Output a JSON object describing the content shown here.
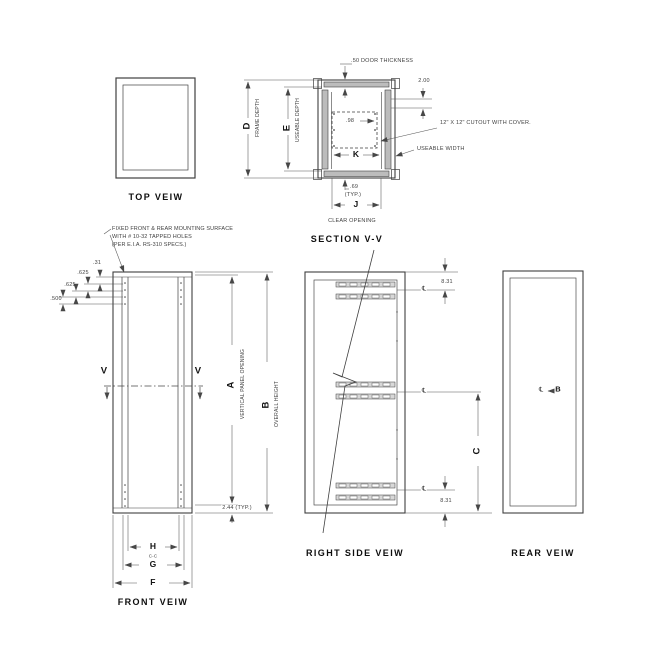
{
  "drawing": {
    "top_view": {
      "title": "TOP VEIW"
    },
    "depth_dims": {
      "d_label": "D",
      "frame_depth": "FRAME DEPTH",
      "e_label": "E",
      "useable_depth": "USEABLE DEPTH"
    },
    "section_view": {
      "title": "SECTION V-V",
      "door_thickness_note": ".50 DOOR THICKNESS",
      "dim_2_00": "2.00",
      "dim_0_98": ".98",
      "cutout_note": "12\" X 12\" CUTOUT WITH COVER.",
      "useable_width_label": "USEABLE WIDTH",
      "k_label": "K",
      "dim_0_69": ".69",
      "typ_note": "(TYP.)",
      "j_label": "J",
      "clear_opening_label": "CLEAR OPENING"
    },
    "front_view": {
      "title": "FRONT VEIW",
      "mounting_note_line1": "FIXED FRONT & REAR MOUNTING SURFACE",
      "mounting_note_line2": "WITH # 10-32 TAPPED HOLES",
      "mounting_note_line3": "(PER E.I.A. RS-310 SPECS.)",
      "hole_dim_1": ".500",
      "hole_dim_2": ".625",
      "hole_dim_3": ".625",
      "hole_dim_4": ".31",
      "section_cut_label_left": "V",
      "section_cut_label_right": "V",
      "a_label": "A",
      "vertical_panel_opening": "VERTICAL PANEL OPENING",
      "b_label": "B",
      "overall_height": "OVERALL HEIGHT",
      "dim_2_44": "2.44 (TYP.)",
      "h_label": "H",
      "center_to_center": "C-C",
      "g_label": "G",
      "f_label": "F"
    },
    "right_side_view": {
      "title": "RIGHT SIDE VEIW",
      "dim_8_31_top": "8.31",
      "dim_8_31_bottom": "8.31",
      "c_label": "C",
      "centerline_symbol": "℄"
    },
    "rear_view": {
      "title": "REAR VEIW",
      "centerline_symbol": "℄",
      "b_label": "B"
    }
  }
}
